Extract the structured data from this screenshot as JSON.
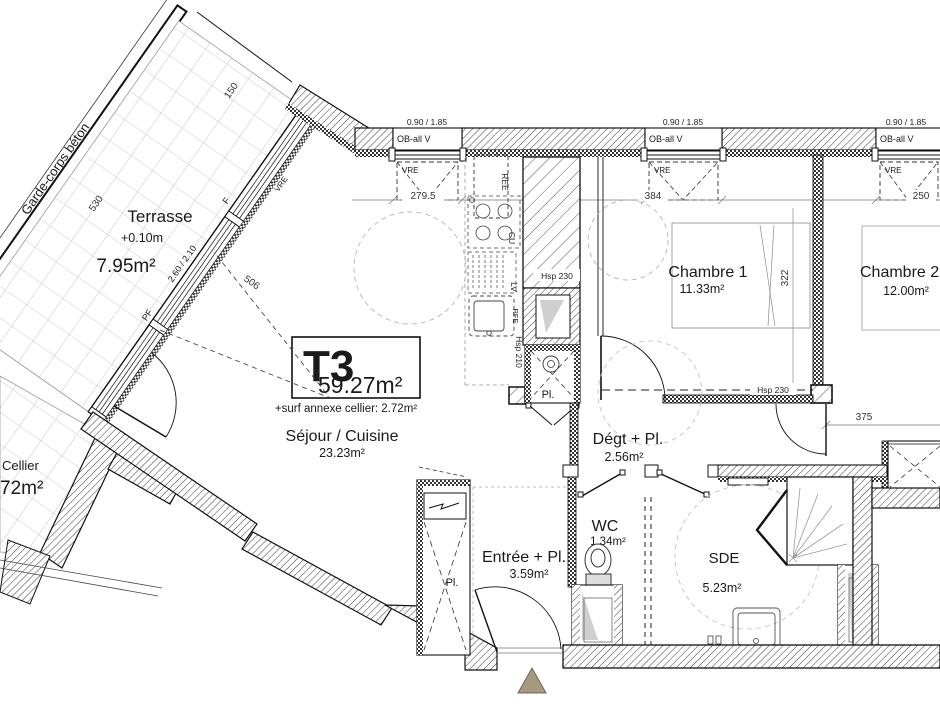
{
  "plan": {
    "title": {
      "type": "T3",
      "area": "59.27m²",
      "annex": "+surf annexe cellier: 2.72m²"
    },
    "rooms": {
      "terrasse": {
        "name": "Terrasse",
        "level": "+0.10m",
        "area": "7.95m²"
      },
      "sejour": {
        "name": "Séjour / Cuisine",
        "area": "23.23m²"
      },
      "chambre1": {
        "name": "Chambre 1",
        "area": "11.33m²"
      },
      "chambre2": {
        "name": "Chambre 2 +",
        "area": "12.00m²"
      },
      "degagement": {
        "name": "Dégt + Pl.",
        "area": "2.56m²"
      },
      "wc": {
        "name": "WC",
        "area": "1.34m²"
      },
      "sde": {
        "name": "SDE",
        "area": "5.23m²"
      },
      "entree": {
        "name": "Entrée + Pl.",
        "area": "3.59m²"
      },
      "cellier": {
        "name": "Cellier",
        "area": "72m²"
      }
    },
    "dims": {
      "terrace_length": "530",
      "terrace_width": "150",
      "bay1": "279.5",
      "bay2": "384",
      "bay3": "250",
      "chambre1_depth": "322",
      "corridor": "375",
      "sejour_depth": "506"
    },
    "windows": {
      "size": "0.90 / 1.85",
      "lintel": "OB-all V",
      "shutter": "VRE"
    },
    "glazing": {
      "size": "2.60 / 2.10",
      "fixed": "F",
      "door": "PF"
    },
    "annotations": {
      "guardrail": "Garde-corps béton",
      "ree": "REE",
      "cu": "CU",
      "lv": "LV",
      "rfe": "RFE",
      "hsp210": "Hsp 210",
      "hsp230": "Hsp 230",
      "pl": "Pl."
    },
    "colors": {
      "entry_marker": "#a59a80",
      "wall": "#1a1a1a",
      "tile": "#c6c6c6"
    }
  }
}
